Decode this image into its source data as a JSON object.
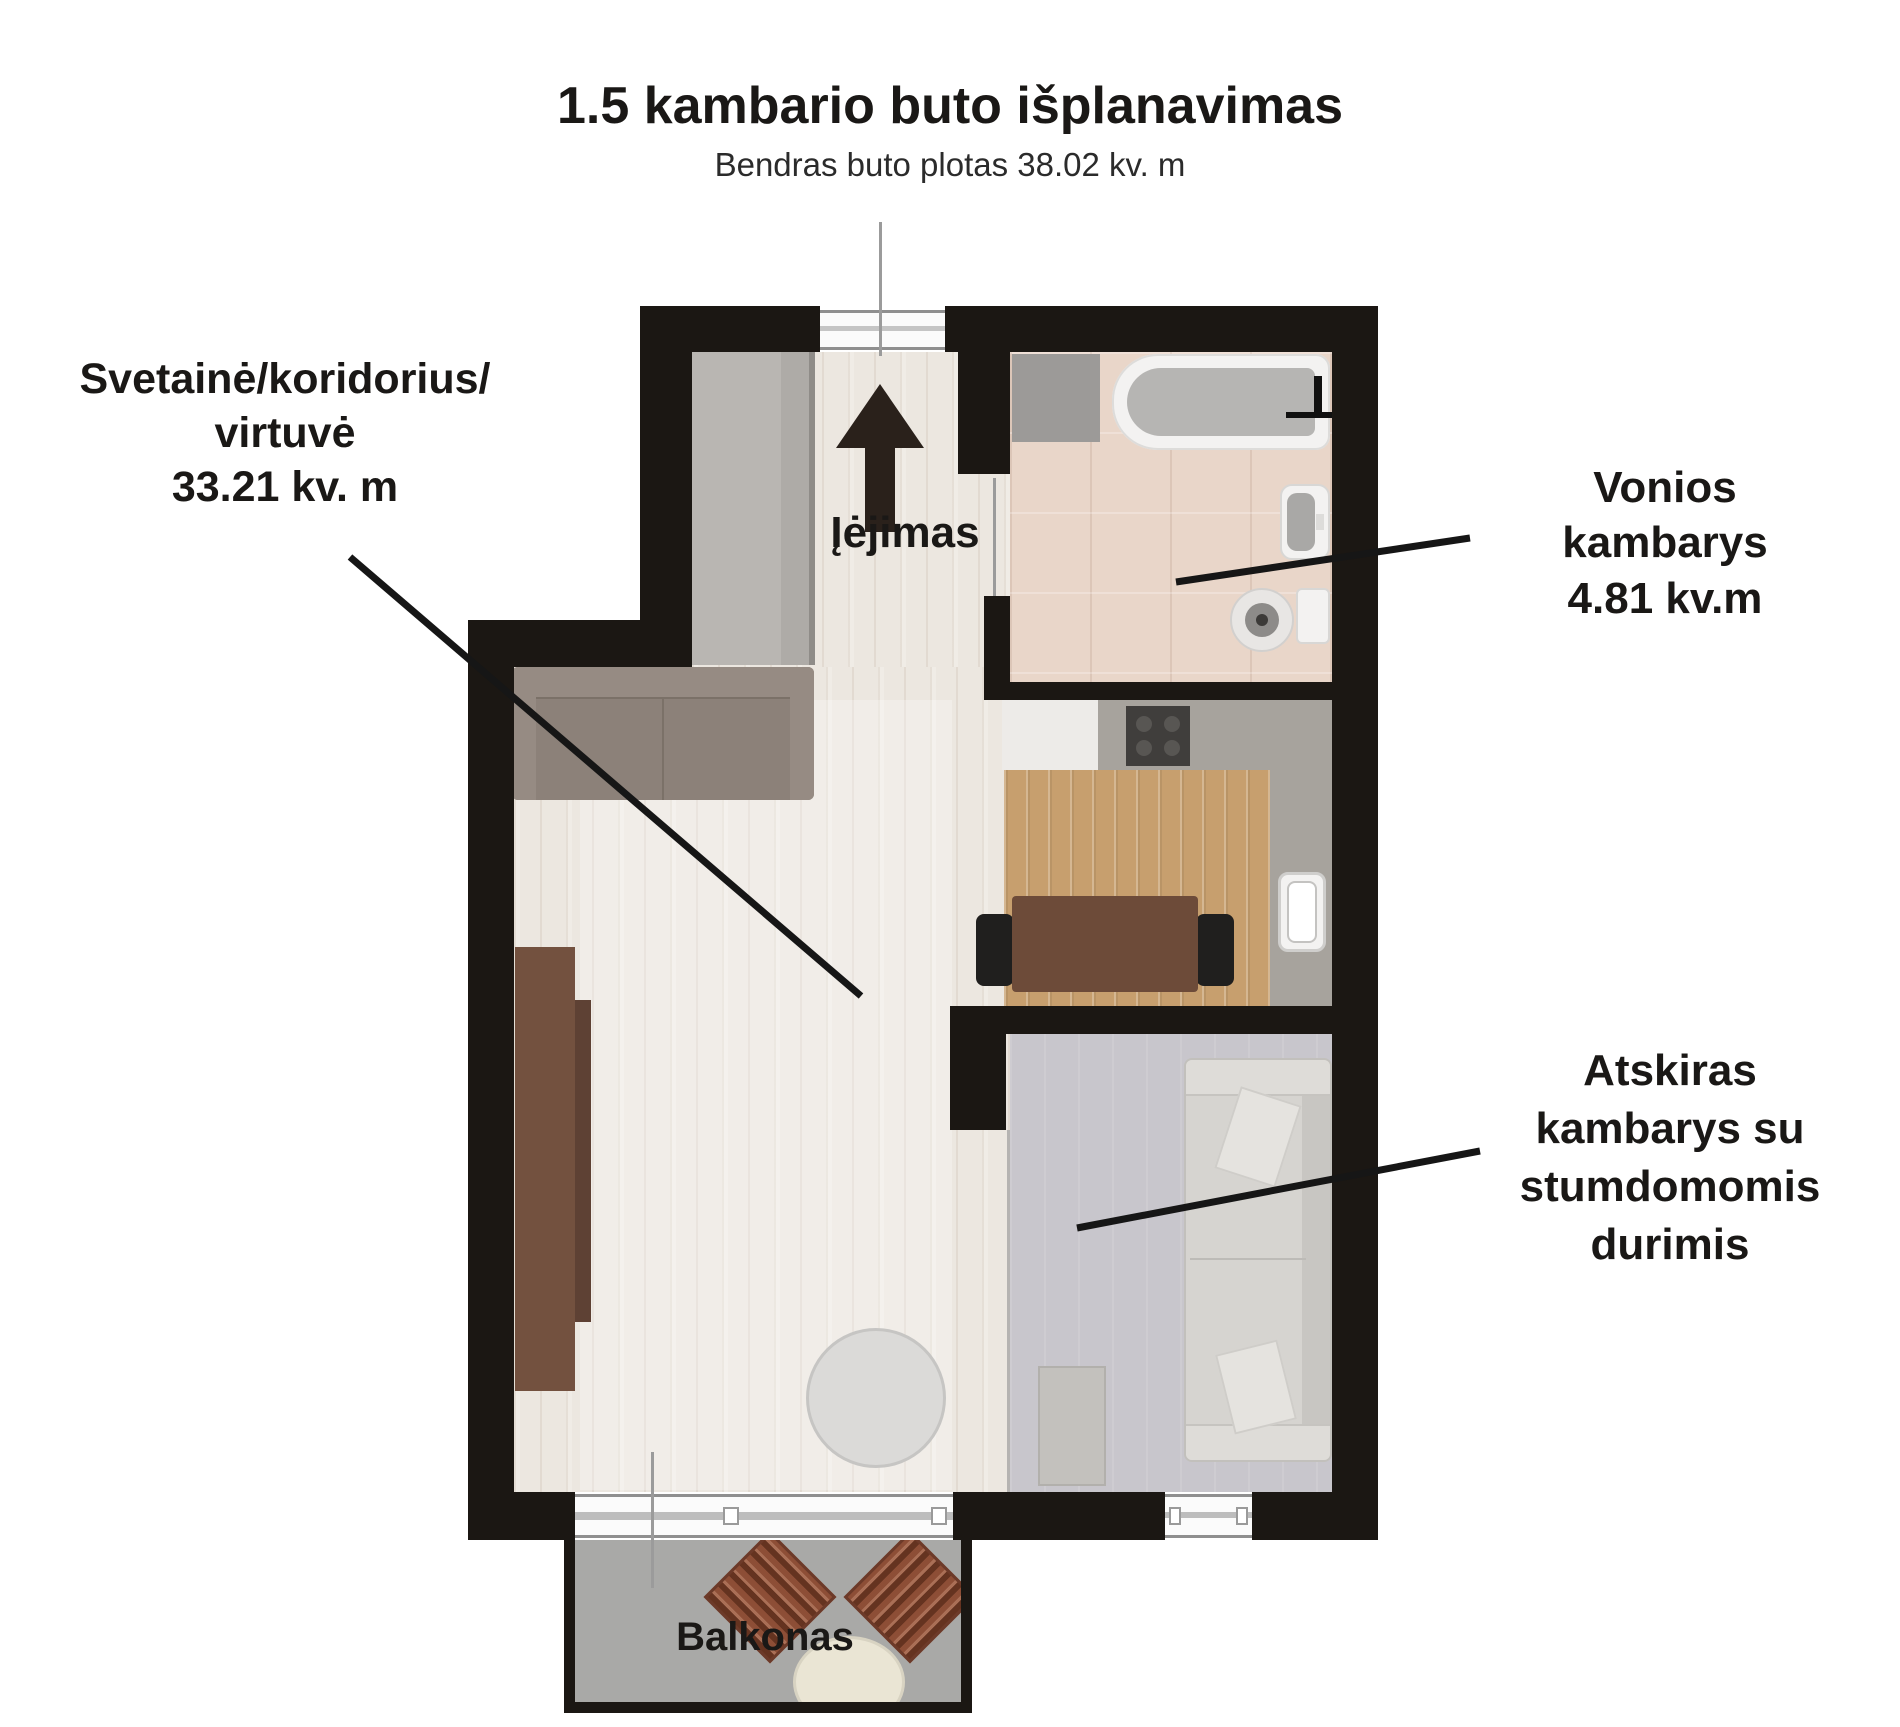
{
  "header": {
    "title": "1.5 kambario buto išplanavimas",
    "subtitle": "Bendras buto plotas 38.02 kv. m"
  },
  "plan": {
    "labels": {
      "living": {
        "lines": [
          "Svetainė/koridorius/",
          "virtuvė",
          "33.21 kv. m"
        ]
      },
      "entrance": {
        "label": "Įėjimas"
      },
      "bathroom": {
        "lines": [
          "Vonios",
          "kambarys",
          "4.81 kv.m"
        ]
      },
      "separate_room": {
        "lines": [
          "Atskiras",
          "kambarys su",
          "stumdomomis",
          "durimis"
        ]
      },
      "balcony": {
        "label": "Balkonas"
      }
    },
    "areas": {
      "living": "33.21 kv. m",
      "bathroom": "4.81 kv.m",
      "total": "38.02 kv. m"
    }
  },
  "colors": {
    "wall": "#1b1713",
    "floorWood": "#ece7e0",
    "floorBath": "#e9d6c9",
    "floorRoom": "#c8c6cc",
    "floorBalcony": "#a9a9a7",
    "kitchenRug": "#c79f6e",
    "counterGray": "#a7a39d",
    "counterWhite": "#edebe8",
    "closet": "#b9b6b2",
    "sofaLiving": "#8c8179",
    "wardrobe": "#73513f",
    "diningTable": "#6d4b39",
    "chair": "#201f1e",
    "stove": "#403e3c",
    "fixture": "#f3f2f1",
    "fixtureGray": "#b6b5b3",
    "sofaRoom": "#d6d4d0",
    "balconyChair": "#8d4e36",
    "balconyTable": "#eae5d4",
    "coffeeTable": "#dbdad8",
    "annotation": "#161616",
    "doorLine": "#9b9b9b",
    "text": "#1a1816",
    "arrow": "#2a211b"
  }
}
